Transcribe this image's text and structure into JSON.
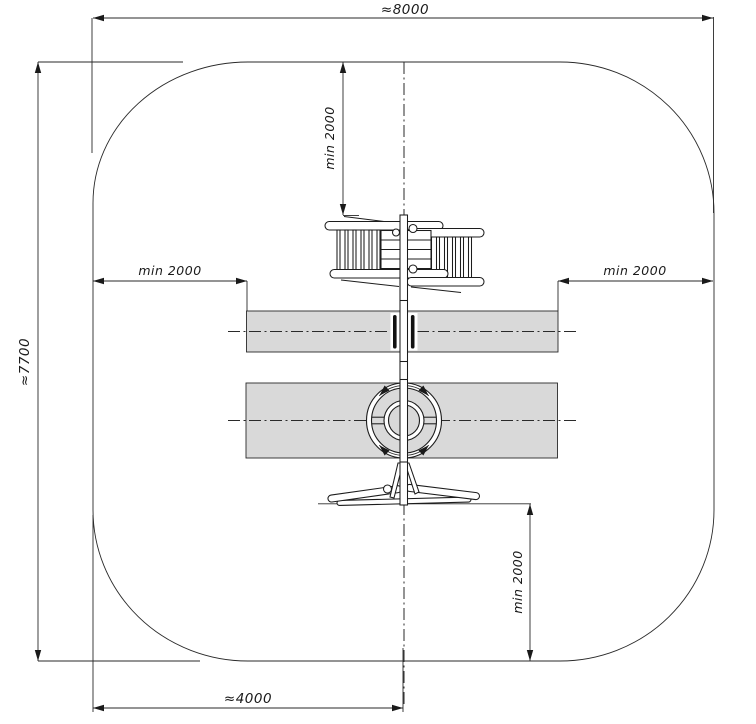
{
  "dimensions": {
    "overall_width_label": "≈8000",
    "overall_height_label": "≈7700",
    "half_width_label": "≈4000",
    "min_clearance_label": "min 2000"
  },
  "colors": {
    "line": "#1c1c1c",
    "impact_zone_fill": "#d9d9d9",
    "background": "#ffffff"
  }
}
